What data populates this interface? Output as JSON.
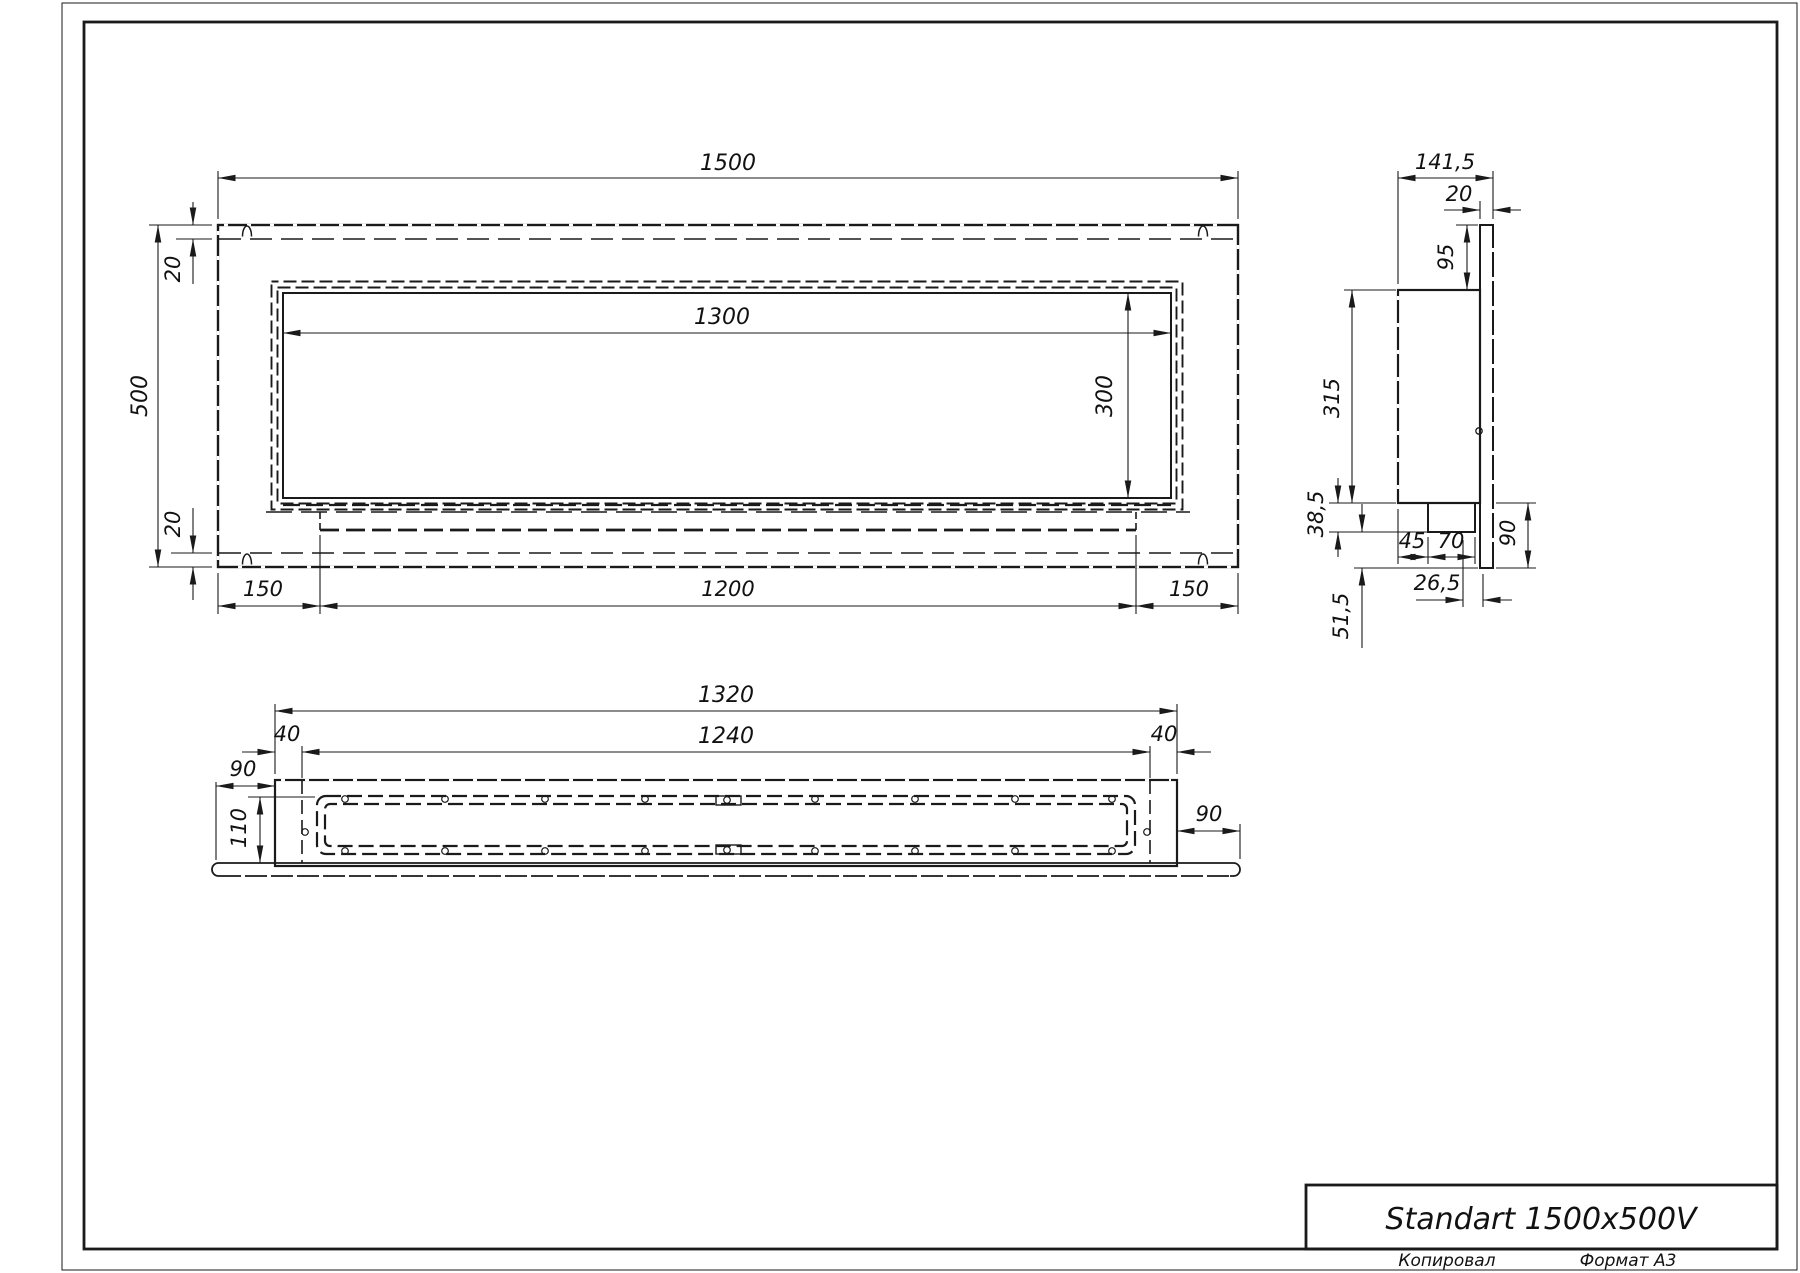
{
  "title_block": {
    "title": "Standart 1500x500V",
    "footer_left": "Копировал",
    "footer_right": "Формат А3"
  },
  "front_view": {
    "dims": {
      "width": "1500",
      "height": "500",
      "top_offset": "20",
      "bottom_offset": "20",
      "opening_width": "1300",
      "opening_height": "300",
      "left_margin": "150",
      "tray_width": "1200",
      "right_margin": "150"
    }
  },
  "side_view": {
    "dims": {
      "depth": "141,5",
      "plate_thickness": "20",
      "top_overhang": "95",
      "box_height": "315",
      "burner_drop": "38,5",
      "burner_offset": "45",
      "burner_width": "70",
      "bottom_overhang": "90",
      "plate_gap": "26,5",
      "lower_section": "51,5"
    }
  },
  "bottom_view": {
    "dims": {
      "body_width": "1320",
      "inner_width": "1240",
      "wall_left": "40",
      "wall_right": "40",
      "flange_left": "90",
      "depth": "110",
      "flange_right": "90"
    }
  }
}
